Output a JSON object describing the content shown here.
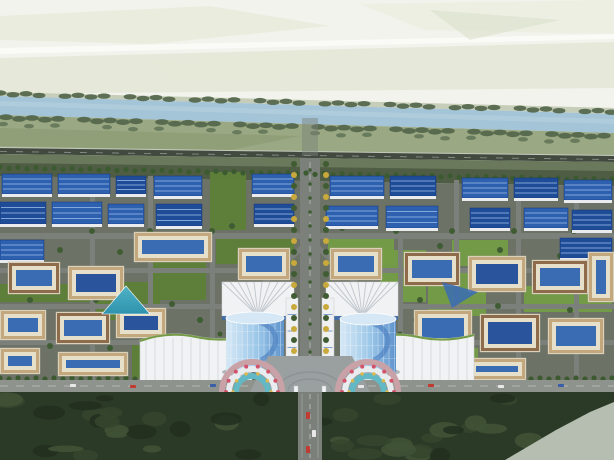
{
  "meta": {
    "description": "aerial rendering of a planned industrial park",
    "width": 614,
    "height": 460
  },
  "scene": {
    "palette": {
      "sky": "#f2f3ec",
      "mist": "#ffffff",
      "field_pale1": "#e4e8d4",
      "field_pale2": "#d8dec6",
      "river": "#a4c4d7",
      "river_hi": "#bad4e2",
      "bank_tree": "#52664a",
      "bank_tree2": "#64785a",
      "field_green": "#9aa883",
      "field_green2": "#8a9a72",
      "highway": "#424a40",
      "highway_edge": "#c9cdc3",
      "slope_top": "#6a785b",
      "slope_bottom": "#4d5a43",
      "park_base": "#6d7267",
      "road": "#7b807b",
      "road_light": "#8e938e",
      "road_dash": "#c2c6c0",
      "lawn": "#5d8038",
      "lawn_light": "#749c46",
      "hedge": "#3c5a2f",
      "factory_roof": "#2d61b0",
      "factory_roof_dark": "#1e4c97",
      "factory_ridge": "#93b5e3",
      "factory_wall": "#e9ebee",
      "court_wall": "#e6dfc9",
      "court_roof_tan": "#c3a87e",
      "court_roof_brown": "#8e6b4b",
      "court_blue": "#3a6cb4",
      "court_blue_dark": "#2a549c",
      "teal": "#4fb2c6",
      "teal_dark": "#2f93ae",
      "tower_hi": "#d6e8f5",
      "tower_mid": "#9ac6e8",
      "tower_lo": "#5e93cc",
      "tower_swoosh": "#4d7fc0",
      "fan_white": "#f1f2f3",
      "fan_stripe": "#c2c9d0",
      "plaza": "#9aa0a0",
      "plaza_arc": "#8a9092",
      "flower_base": "#c9a2a8",
      "flower_red": "#d2526a",
      "flower_teal": "#62b8c4",
      "flower_white": "#e8ecee",
      "flower_gold": "#e0b848",
      "gold_tree": "#c9a93c",
      "green_tree": "#3f5c33",
      "forest": "#2b3927",
      "forest_blob1": "#35462e",
      "forest_blob2": "#223020",
      "forest_blob3": "#405236",
      "patch": "#b5beb0",
      "car_red": "#c23b30",
      "car_white": "#e8e8e8",
      "car_blue": "#3a5fa8"
    },
    "background": {
      "patches": [
        {
          "points": "0,16 210,6 330,26 150,44 0,40",
          "fill": "field_pale1",
          "opacity": 0.55
        },
        {
          "points": "360,4 614,0 614,34 424,30",
          "fill": "field_pale1",
          "opacity": 0.4
        },
        {
          "points": "0,58 614,42 614,88 0,94",
          "fill": "field_pale2",
          "opacity": 0.45
        },
        {
          "points": "0,48 614,34 614,39 0,54",
          "fill": "mist",
          "opacity": 0.6
        },
        {
          "points": "430,10 560,20 470,40",
          "fill": "field_pale2",
          "opacity": 0.5
        },
        {
          "points": "150,60 340,50 300,78 170,82",
          "fill": "field_pale1",
          "opacity": 0.35
        }
      ]
    },
    "river": {
      "body": "0,96 614,114 614,133 0,115",
      "highlight": "0,101 614,119 614,124 0,106"
    },
    "fields": {
      "above": "0,92 614,108 614,114 0,96",
      "below": "0,115 614,133 614,157 0,149",
      "below2": "0,128 300,136 230,150 0,146"
    },
    "highway": {
      "body": "0,148 614,156 614,162 0,154",
      "edge": "0,147 614,155 614,156.2 0,148.2",
      "dash": "M0,151.5 L614,159.5"
    },
    "slope": {
      "upper": "0,154 614,162 614,186 0,176",
      "lower": "0,163 614,171 614,186 0,176"
    },
    "park": {
      "base": "0,176 614,186 614,392 0,392"
    },
    "bank_tree_rows": [
      {
        "x0": 0,
        "x1": 614,
        "y0": 93,
        "y1": 111,
        "step": 13,
        "rx": 6.4,
        "ry": 2.7,
        "color": "bank_tree",
        "gapMod": 5
      },
      {
        "x0": 6,
        "x1": 614,
        "y0": 117,
        "y1": 136,
        "step": 13,
        "rx": 6.8,
        "ry": 2.9,
        "color": "bank_tree",
        "gapMod": 6
      },
      {
        "x0": 3,
        "x1": 614,
        "y0": 124,
        "y1": 142,
        "step": 26,
        "rx": 5,
        "ry": 2.2,
        "color": "bank_tree2",
        "gapMod": 4
      }
    ],
    "roads_h": [
      [
        0,
        233,
        614,
        6
      ],
      [
        0,
        268,
        240,
        5
      ],
      [
        374,
        268,
        240,
        5
      ],
      [
        0,
        304,
        232,
        5
      ],
      [
        384,
        304,
        230,
        5
      ],
      [
        0,
        340,
        222,
        5
      ],
      [
        394,
        340,
        220,
        5
      ]
    ],
    "roads_v": [
      [
        90,
        176,
        5,
        206
      ],
      [
        148,
        176,
        5,
        206
      ],
      [
        210,
        233,
        5,
        149
      ],
      [
        398,
        233,
        5,
        149
      ],
      [
        454,
        180,
        5,
        202
      ],
      [
        516,
        182,
        5,
        200
      ],
      [
        574,
        184,
        5,
        198
      ]
    ],
    "diagonal_roads": [
      [
        310,
        240,
        243,
        303,
        5
      ],
      [
        310,
        240,
        377,
        303,
        5
      ],
      [
        268,
        378,
        220,
        342,
        4
      ],
      [
        352,
        378,
        400,
        342,
        4
      ]
    ],
    "axis": {
      "north": [
        302,
        118,
        16,
        38
      ],
      "main": [
        300,
        158,
        20,
        234
      ],
      "south": [
        298,
        392,
        24,
        68
      ],
      "median": "M310,162 L310,392",
      "south_median": "M310,394 L310,458",
      "south_edges": [
        "M302,394 L302,458",
        "M318,394 L318,458"
      ]
    },
    "perimeter": {
      "rect": [
        0,
        380,
        614,
        12
      ],
      "dash": "M0,386 L614,386"
    },
    "plaza": {
      "points": "268,356 352,356 370,392 250,392",
      "arcs": [
        "M278,390 A32,18 0 0 1 342,390",
        "M288,391 A22,12 0 0 1 332,391"
      ]
    },
    "lawns": [
      [
        216,
        236,
        78,
        28
      ],
      [
        328,
        236,
        66,
        28
      ],
      [
        96,
        282,
        64,
        38
      ],
      [
        428,
        270,
        58,
        46
      ],
      [
        152,
        252,
        54,
        48
      ],
      [
        380,
        250,
        46,
        52
      ],
      [
        210,
        172,
        36,
        58
      ],
      [
        452,
        240,
        56,
        26
      ],
      [
        0,
        284,
        90,
        18
      ],
      [
        524,
        286,
        88,
        26
      ],
      [
        132,
        344,
        64,
        34
      ],
      [
        418,
        348,
        60,
        30
      ]
    ],
    "factories": [
      [
        2,
        174,
        50,
        20,
        "n"
      ],
      [
        58,
        174,
        52,
        20,
        "n"
      ],
      [
        116,
        176,
        30,
        18,
        "d"
      ],
      [
        154,
        176,
        48,
        20,
        "n"
      ],
      [
        252,
        174,
        42,
        20,
        "n"
      ],
      [
        330,
        176,
        54,
        20,
        "n"
      ],
      [
        390,
        176,
        46,
        20,
        "d"
      ],
      [
        462,
        178,
        46,
        20,
        "n"
      ],
      [
        514,
        178,
        44,
        20,
        "d"
      ],
      [
        564,
        180,
        48,
        20,
        "n"
      ],
      [
        0,
        202,
        46,
        22,
        "d"
      ],
      [
        52,
        202,
        50,
        22,
        "n"
      ],
      [
        108,
        204,
        36,
        20,
        "n"
      ],
      [
        156,
        204,
        46,
        22,
        "d"
      ],
      [
        254,
        204,
        40,
        20,
        "d"
      ],
      [
        326,
        206,
        52,
        20,
        "n"
      ],
      [
        386,
        206,
        52,
        22,
        "n"
      ],
      [
        470,
        208,
        40,
        20,
        "d"
      ],
      [
        524,
        208,
        44,
        20,
        "n"
      ],
      [
        572,
        210,
        40,
        20,
        "d"
      ],
      [
        0,
        240,
        44,
        20,
        "n"
      ],
      [
        560,
        238,
        52,
        20,
        "d"
      ]
    ],
    "courtyards": [
      [
        134,
        232,
        78,
        30,
        "tan",
        "blue"
      ],
      [
        8,
        262,
        52,
        32,
        "brown",
        "blue"
      ],
      [
        68,
        266,
        56,
        34,
        "tan",
        "dark"
      ],
      [
        0,
        310,
        46,
        30,
        "tan",
        "blue"
      ],
      [
        56,
        312,
        54,
        32,
        "brown",
        "blue"
      ],
      [
        116,
        308,
        50,
        30,
        "tan",
        "dark"
      ],
      [
        238,
        248,
        52,
        32,
        "tan",
        "blue"
      ],
      [
        330,
        248,
        52,
        32,
        "tan",
        "blue"
      ],
      [
        404,
        252,
        56,
        34,
        "brown",
        "blue"
      ],
      [
        468,
        256,
        58,
        36,
        "tan",
        "dark"
      ],
      [
        532,
        260,
        56,
        34,
        "brown",
        "blue"
      ],
      [
        414,
        310,
        58,
        36,
        "tan",
        "blue"
      ],
      [
        480,
        314,
        60,
        38,
        "brown",
        "dark"
      ],
      [
        548,
        318,
        56,
        36,
        "tan",
        "blue"
      ],
      [
        588,
        252,
        26,
        50,
        "tan",
        "blue"
      ],
      [
        0,
        348,
        40,
        26,
        "tan",
        "blue"
      ],
      [
        58,
        352,
        70,
        24,
        "tan",
        "blue"
      ],
      [
        468,
        358,
        58,
        22,
        "tan",
        "blue"
      ]
    ],
    "glass_pyramid": "126,286 150,314 102,314",
    "pond": "442,282 478,292 452,308",
    "fan_buildings": [
      [
        222,
        282,
        72,
        34
      ],
      [
        326,
        282,
        72,
        34
      ]
    ],
    "slab_towers": [
      [
        286,
        298,
        12,
        66
      ],
      [
        322,
        298,
        12,
        66
      ]
    ],
    "malls": [
      [
        140,
        330,
        112,
        52
      ],
      [
        362,
        330,
        112,
        52
      ]
    ],
    "towers": [
      [
        226,
        318,
        58,
        54
      ],
      [
        340,
        319,
        56,
        53
      ]
    ],
    "flower_terraces": [
      {
        "cx": 252,
        "cy": 392
      },
      {
        "cx": 368,
        "cy": 392
      }
    ],
    "gate_posts": [
      [
        294,
        386,
        4,
        9
      ],
      [
        322,
        386,
        4,
        9
      ]
    ],
    "hedgerows": [
      {
        "x1": 0,
        "y1": 167,
        "x2": 614,
        "y2": 179,
        "step": 9,
        "r": 2.6,
        "color": "hedge",
        "jitter": 1.2
      },
      {
        "x1": 0,
        "y1": 378,
        "x2": 614,
        "y2": 378,
        "step": 9,
        "r": 2.6,
        "color": "hedge",
        "gap": [
          286,
          334
        ],
        "jitter": 1
      }
    ],
    "hedgecols": [
      {
        "x": 220,
        "y1": 334,
        "y2": 378,
        "step": 7,
        "r": 2.5,
        "color": "hedge"
      },
      {
        "x": 400,
        "y1": 334,
        "y2": 378,
        "step": 7,
        "r": 2.5,
        "color": "hedge"
      },
      {
        "x": 292,
        "y1": 398,
        "y2": 456,
        "step": 8,
        "r": 2.6,
        "color": "forest_blob3"
      },
      {
        "x": 328,
        "y1": 398,
        "y2": 456,
        "step": 8,
        "r": 2.6,
        "color": "forest_blob3"
      }
    ],
    "tree_columns": [
      {
        "x": 294,
        "y1": 164,
        "y2": 356,
        "step": 11,
        "r": 3,
        "alt": true
      },
      {
        "x": 326,
        "y1": 164,
        "y2": 356,
        "step": 11,
        "r": 3,
        "alt": true
      },
      {
        "x": 310,
        "y1": 170,
        "y2": 352,
        "step": 14,
        "r": 1.8,
        "color": "green_tree"
      }
    ],
    "trees": [
      [
        92,
        231
      ],
      [
        150,
        231
      ],
      [
        212,
        231
      ],
      [
        396,
        231
      ],
      [
        452,
        231
      ],
      [
        514,
        231
      ],
      [
        574,
        231
      ],
      [
        60,
        250
      ],
      [
        120,
        252
      ],
      [
        180,
        256
      ],
      [
        440,
        246
      ],
      [
        500,
        250
      ],
      [
        560,
        256
      ],
      [
        30,
        300
      ],
      [
        96,
        300
      ],
      [
        172,
        304
      ],
      [
        420,
        300
      ],
      [
        498,
        306
      ],
      [
        570,
        310
      ],
      [
        50,
        346
      ],
      [
        110,
        348
      ],
      [
        470,
        344
      ],
      [
        530,
        348
      ],
      [
        590,
        350
      ],
      [
        200,
        320
      ],
      [
        416,
        320
      ],
      [
        232,
        226
      ],
      [
        342,
        228
      ]
    ],
    "forest": {
      "seed": 7,
      "count": 44,
      "x0": 0,
      "x1": 614,
      "y0": 398,
      "y1": 456,
      "rxMin": 7,
      "rxMax": 18,
      "ryMin": 3,
      "ryMax": 8,
      "colors": [
        "forest_blob1",
        "forest_blob2",
        "forest_blob3"
      ]
    },
    "patch": "614,402 614,460 505,460 556,430 590,412",
    "cars": [
      [
        70,
        384,
        6,
        3,
        "car_white"
      ],
      [
        130,
        385,
        6,
        3,
        "car_red"
      ],
      [
        210,
        384,
        6,
        3,
        "car_blue"
      ],
      [
        358,
        385,
        6,
        3,
        "car_white"
      ],
      [
        428,
        384,
        6,
        3,
        "car_red"
      ],
      [
        498,
        385,
        6,
        3,
        "car_white"
      ],
      [
        558,
        384,
        6,
        3,
        "car_blue"
      ],
      [
        306,
        412,
        4,
        7,
        "car_red"
      ],
      [
        312,
        430,
        4,
        7,
        "car_white"
      ],
      [
        306,
        446,
        4,
        7,
        "car_red"
      ]
    ]
  }
}
